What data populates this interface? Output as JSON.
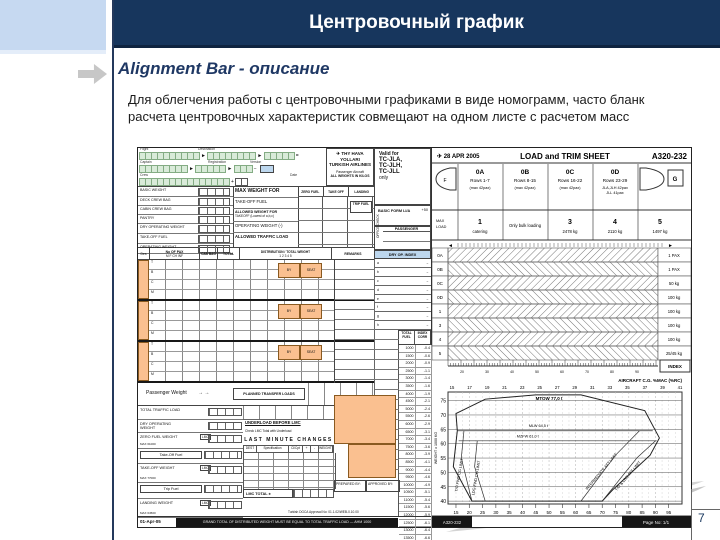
{
  "slide": {
    "title": "Центровочный график",
    "heading": "Alignment Bar - описание",
    "body_line1": "Для облегчения работы с центровочными графиками в виде номограмм, часто бланк",
    "body_line2": "расчета центровочных характеристик совмещают на одном листе с расчетом масс",
    "page_number": "7",
    "colors": {
      "header_navy": "#17365D",
      "corner_blue": "#C6D9F1",
      "heading_navy": "#1F3864",
      "form_orange": "#FAC090",
      "form_green": "#D9EBD9",
      "form_lightblue": "#BDD7EE"
    }
  },
  "form": {
    "airline": {
      "name1": "THY HAVA YOLLARI",
      "name2": "TURKISH AIRLINES",
      "sub1": "Passenger Aircraft",
      "sub2": "ALL WEIGHTS IN KILOS"
    },
    "valid": {
      "title": "Valid for",
      "regs": [
        "TC-JLA,",
        "TC-JLH,",
        "TC-JLL"
      ],
      "only": "only"
    },
    "basic_form": "BASIC FORM LI/A",
    "basic_form2": "+50",
    "passenger": "PASSENGER",
    "office_check": "OFFICE CHECK",
    "dry_op_index": "DRY OP. INDEX",
    "field_labels": {
      "r1a": "Flight",
      "r1b": "Destination",
      "r2a": "Captain",
      "r2b": "Registration",
      "r2c": "Version",
      "r3a": "Crew",
      "r3b": "Date"
    },
    "weight_rows": [
      "BASIC WEIGHT",
      "DECK CREW BAG",
      "CABIN CREW BAG",
      "PANTRY",
      "DRY OPERATING WEIGHT",
      "TAKE-OFF FUEL",
      "OPERATING WEIGHT"
    ],
    "max_block": {
      "title": "MAX WEIGHT FOR",
      "cols": [
        "ZERO FUEL",
        "TAKE OFF",
        "LANDING"
      ],
      "r2": "TAKE-OFF FUEL",
      "trip": "TRIP FUEL",
      "r3": "ALLOWED WEIGHT FOR",
      "r3b": "TAKEOFF (Lowest of a,b,c)",
      "r4": "OPERATING WEIGHT (-)",
      "r5": "ALLOWED TRAFFIC LOAD"
    },
    "pax_header": {
      "des": "Des",
      "no_of_pax": "No OF PAX",
      "sub": [
        "M",
        "F",
        "CH",
        "INF"
      ],
      "cab_bag": "CAB BAG",
      "total": "TOTAL",
      "dist": "DISTRIBUTION / TOTAL WEIGHT",
      "cols": [
        "1",
        "2",
        "3",
        "4",
        "5"
      ],
      "remarks": "REMARKS"
    },
    "dest_letters": [
      "T",
      "B",
      "C",
      "M"
    ],
    "by_seat": {
      "by": "BY",
      "seat": "SEAT"
    },
    "passenger_weight": "Passenger Weight",
    "transfer_box": "PLANNED TRANSFER LOADS",
    "totals": {
      "rows": [
        "TOTAL TRAFFIC LOAD",
        "DRY OPERATING WEIGHT",
        "ZERO FUEL WEIGHT",
        "Take-Off Fuel",
        "TAKE-OFF WEIGHT",
        "Trip Fuel",
        "LANDING WEIGHT"
      ],
      "lmc": "LMC",
      "max_zfw": "MAX 61000",
      "max_tow": "MAX 77000",
      "max_ldw": "MAX 64500"
    },
    "underload": "UNDERLOAD BEFORE LMC",
    "underload_note": "Check LMC Total with Underload",
    "last_minute": "LAST MINUTE CHANGES",
    "lmc_cols": [
      "DEST",
      "Specification",
      "Cl/Cpt",
      "+",
      "-",
      "WEIGHT"
    ],
    "lmc_total": "LMC TOTAL ±",
    "prepared_by": "PREPARED BY:",
    "approved_by": "APPROVED BY:",
    "approval_note": "Turkish DGCA Approval No: 01.1.02/WEB-0.10.00",
    "footer_date": "01-Apr-05",
    "footer_strip": "GRAND TOTAL OF DISTRIBUTED WEIGHT MUST BE EQUAL TO TOTAL TRAFFIC LOAD — AHM 1000",
    "index_rows": [
      "a",
      "b",
      "c",
      "d",
      "e",
      "f",
      "g",
      "h"
    ],
    "fuel_table": {
      "h1": "TOTAL FUEL",
      "h2": "INDEX CORR",
      "rows": [
        [
          "1000",
          "-0.4"
        ],
        [
          "1500",
          "-0.6"
        ],
        [
          "2000",
          "-0.9"
        ],
        [
          "2500",
          "-1.1"
        ],
        [
          "3000",
          "-1.4"
        ],
        [
          "3500",
          "-1.6"
        ],
        [
          "4000",
          "-1.9"
        ],
        [
          "4500",
          "-2.1"
        ],
        [
          "5000",
          "-2.4"
        ],
        [
          "5500",
          "-2.6"
        ],
        [
          "6000",
          "-2.9"
        ],
        [
          "6500",
          "-3.1"
        ],
        [
          "7000",
          "-3.4"
        ],
        [
          "7500",
          "-3.6"
        ],
        [
          "8000",
          "-3.9"
        ],
        [
          "8500",
          "-4.1"
        ],
        [
          "9000",
          "-4.4"
        ],
        [
          "9500",
          "-4.6"
        ],
        [
          "10000",
          "-4.9"
        ],
        [
          "10500",
          "-5.1"
        ],
        [
          "11000",
          "-5.4"
        ],
        [
          "11500",
          "-5.6"
        ],
        [
          "12000",
          "-5.9"
        ],
        [
          "12500",
          "-6.1"
        ],
        [
          "13000",
          "-6.4"
        ],
        [
          "13500",
          "-6.6"
        ]
      ]
    },
    "right": {
      "date": "28 APR 2005",
      "title": "LOAD and TRIM SHEET",
      "model": "A320-232",
      "sections": [
        {
          "code": "0A",
          "rows": "Rows 1-7",
          "note": "(max 42pax)"
        },
        {
          "code": "0B",
          "rows": "Rows 8-15",
          "note": "(max 42pax)"
        },
        {
          "code": "0C",
          "rows": "Rows 16-22",
          "note": "(max 42pax)"
        },
        {
          "code": "0D",
          "rows": "Rows 23-29",
          "note": "JLA,JLH 42pax·JLL 41pax"
        }
      ],
      "nose_label": "F",
      "tail_label": "G",
      "max_load": "MAX LOAD",
      "holds": [
        {
          "num": "1",
          "note": "catering"
        },
        {
          "num": "",
          "note": "Only bulk loading"
        },
        {
          "num": "3",
          "note": "2478 kg"
        },
        {
          "num": "4",
          "note": "2110 kg"
        },
        {
          "num": "5",
          "note": "1497 kg"
        }
      ],
      "bars": [
        {
          "label": "0A",
          "unit": "1 PAX"
        },
        {
          "label": "0B",
          "unit": "1 PAX"
        },
        {
          "label": "0C",
          "unit": "50 kg"
        },
        {
          "label": "0D",
          "unit": "100 kg"
        },
        {
          "label": "1",
          "unit": "100 kg"
        },
        {
          "label": "3",
          "unit": "100 kg"
        },
        {
          "label": "4",
          "unit": "100 kg"
        },
        {
          "label": "5",
          "unit": "25/45 kg"
        }
      ],
      "index_numbers": [
        20,
        30,
        40,
        50,
        60,
        70,
        80,
        90
      ],
      "index_box": "INDEX",
      "footer_left": "A320-232",
      "page": "Page No: 1/1"
    },
    "chart_data": {
      "type": "area",
      "title": "A320-232 centre-of-gravity envelope (trim nomogram)",
      "x_top_label": "AIRCRAFT C.G. %MAC (%RC)",
      "x_top_ticks": [
        15,
        17,
        19,
        21,
        23,
        25,
        27,
        29,
        31,
        33,
        35,
        37,
        39,
        41
      ],
      "x_bottom_ticks": [
        15,
        20,
        25,
        30,
        35,
        40,
        45,
        50,
        55,
        60,
        65,
        70,
        75,
        80,
        85,
        90,
        95
      ],
      "y_label": "WEIGHT x 1000 KG",
      "y_ticks": [
        40,
        45,
        50,
        55,
        60,
        65,
        70,
        75
      ],
      "x_range": [
        12,
        100
      ],
      "y_range": [
        39,
        78
      ],
      "envelope": [
        [
          21,
          40
        ],
        [
          14,
          52
        ],
        [
          15.5,
          64.5
        ],
        [
          15,
          70.5
        ],
        [
          26,
          75.5
        ],
        [
          45,
          77
        ],
        [
          62,
          77
        ],
        [
          86,
          71.5
        ],
        [
          91.5,
          62
        ],
        [
          88,
          56
        ],
        [
          74,
          44
        ],
        [
          70,
          40
        ]
      ],
      "top_label": "MTOW 77,0 t",
      "limit_lines": [
        {
          "name": "MLW 64,5 t",
          "points": [
            [
              15.5,
              64.5
            ],
            [
              89,
              64.5
            ]
          ],
          "label_pos": [
            46,
            65.8,
            0
          ]
        },
        {
          "name": "MZFW 61,0 t",
          "points": [
            [
              16,
              61
            ],
            [
              90.5,
              61
            ]
          ],
          "label_pos": [
            42,
            62.2,
            0
          ]
        },
        {
          "name": "T/O FWD CG LIMIT",
          "points": [
            [
              21,
              40
            ],
            [
              17,
              55
            ],
            [
              18,
              64.5
            ]
          ],
          "label_pos": [
            16.6,
            49,
            -80
          ]
        },
        {
          "name": "LDG FWD CG LIMIT",
          "points": [
            [
              26,
              40
            ],
            [
              22,
              52
            ],
            [
              23,
              61
            ]
          ],
          "label_pos": [
            23,
            48,
            -80
          ]
        },
        {
          "name": "INTERMEDIATE AFT LIMIT",
          "points": [
            [
              62,
              40
            ],
            [
              75,
              56
            ],
            [
              84,
              64.5
            ]
          ],
          "label_pos": [
            70,
            50,
            -50
          ]
        },
        {
          "name": "T/O & LDG AFT LIMIT",
          "points": [
            [
              70,
              40
            ],
            [
              83,
              55
            ],
            [
              90,
              61
            ]
          ],
          "label_pos": [
            80,
            48.5,
            -50
          ]
        }
      ]
    }
  }
}
